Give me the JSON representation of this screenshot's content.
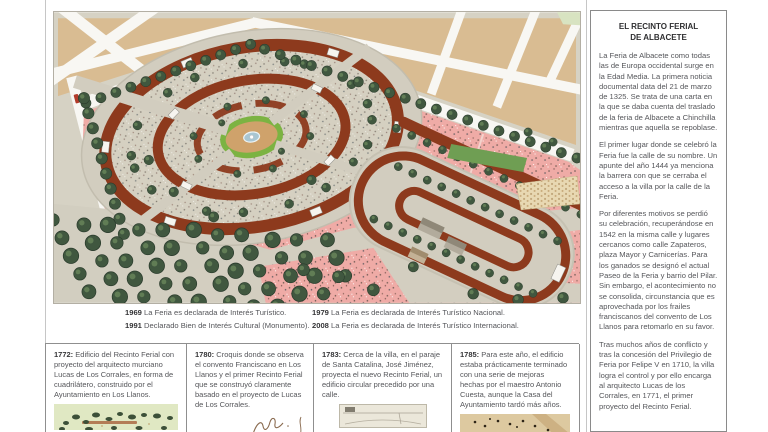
{
  "colors": {
    "building_brown": "#8d3a1d",
    "esplanade_pink": "#efaba6",
    "city_tan": "#d9bc92",
    "ground_grey": "#d6d2c4",
    "tree_green": "#40573f",
    "grass_green": "#6f9e53",
    "hedge_green": "#7cb342"
  },
  "sidebar": {
    "title_line1": "EL RECINTO FERIAL",
    "title_line2": "DE ALBACETE",
    "paragraphs": [
      "La Feria de Albacete como todas las de Europa occidental surge en la Edad Media. La primera noticia documental data del 21 de marzo de 1325. Se trata de una carta en la que se daba cuenta del traslado de la feria de Albacete a Chinchilla mientras que aquella se repoblase.",
      "El primer lugar donde se celebró la Feria fue la calle de su nombre. Un apunte del año 1444 ya menciona la barrera con que se cerraba el acceso a la villa por la calle de la Feria.",
      "Por diferentes motivos se perdió su celebración, recuperándose en 1542 en la misma calle y lugares cercanos como calle Zapateros, plaza Mayor y Carnicerías. Para los ganados se designó el actual Paseo de la Feria y barrio del Pilar. Sin embargo, el acontecimiento no se consolida, circunstancia que es aprovechada por los frailes franciscanos del convento de Los Llanos para retomarlo en su favor.",
      "Tras muchos años de conflicto y tras la concesión del Privilegio de Feria por Felipe V en 1710, la villa logra el control y por ello encarga al arquitecto Lucas de los Corrales, en 1771, el primer proyecto del Recinto Ferial."
    ]
  },
  "timeline": {
    "left": [
      {
        "year": "1969",
        "text": "La Feria es declarada de Interés Turístico."
      },
      {
        "year": "1991",
        "text": "Declarado Bien de Interés Cultural (Monumento)."
      }
    ],
    "right": [
      {
        "year": "1979",
        "text": "La Feria es declarada de Interés Turístico Nacional."
      },
      {
        "year": "2008",
        "text": "La Feria es declarada de Interés Turístico Internacional."
      }
    ]
  },
  "milestones": [
    {
      "year": "1772:",
      "text": "Edificio del Recinto Ferial con proyecto del arquitecto murciano Lucas de Los Corrales, en forma de cuadrilátero, construido por el Ayuntamiento en Los Llanos."
    },
    {
      "year": "1780:",
      "text": "Croquis donde se observa el convento Franciscano en Los Llanos y el primer Recinto Ferial que se construyó claramente basado en el proyecto de Lucas de Los Corrales."
    },
    {
      "year": "1783:",
      "text": "Cerca de la villa, en el paraje de Santa Catalina, José Jiménez, proyecta el nuevo Recinto Ferial, un edificio circular precedido por una calle."
    },
    {
      "year": "1785:",
      "text": "Para este año, el edificio estaba prácticamente terminado con una serie de mejoras hechas por el maestro Antonio Cuesta, aunque la Casa del Ayuntamiento tardó más años."
    }
  ]
}
